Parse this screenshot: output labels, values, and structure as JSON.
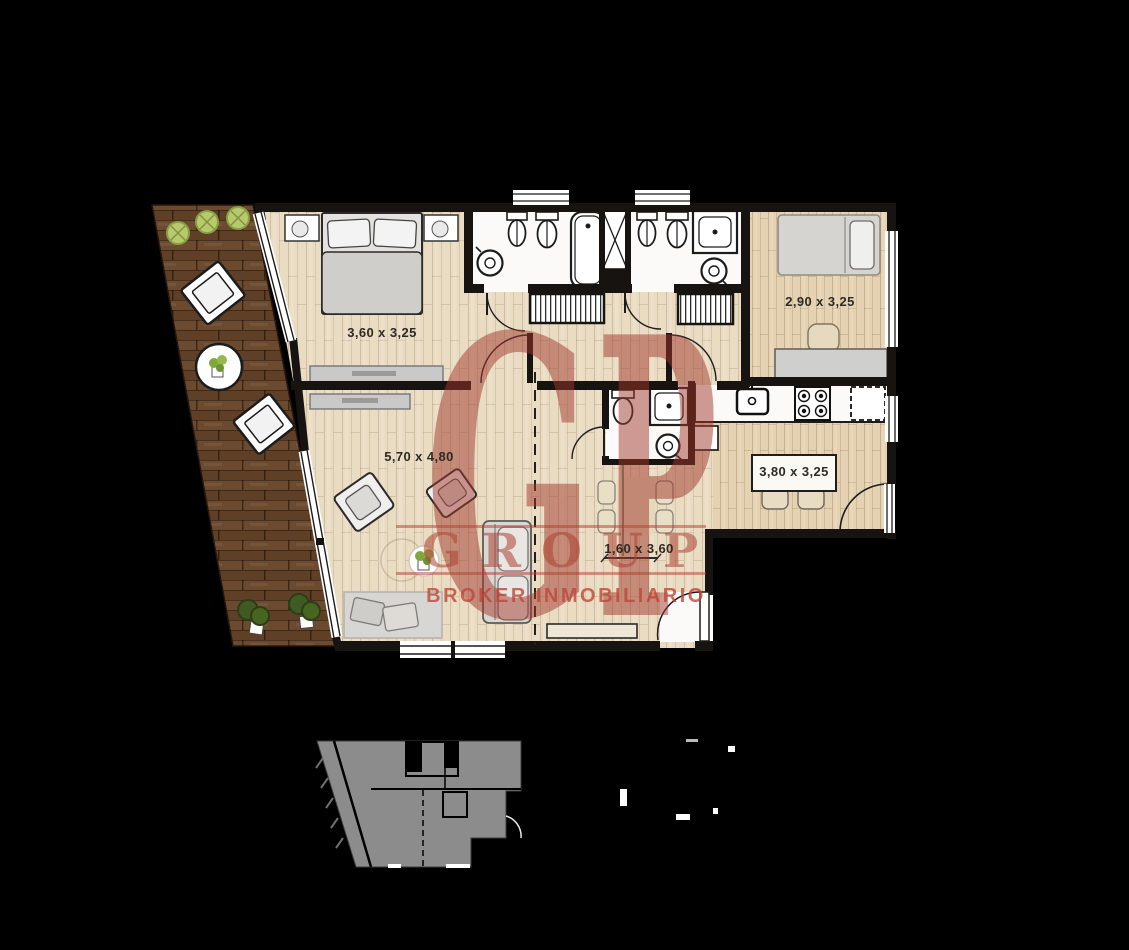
{
  "watermark": {
    "big_letters": [
      "G",
      "P"
    ],
    "line1": "GROUP",
    "line2": "BROKER INMOBILIARIO",
    "color": "#ad4032"
  },
  "rooms": [
    {
      "name": "bedroom-1",
      "dimension": "3,60 x 3,25"
    },
    {
      "name": "bedroom-2",
      "dimension": "2,90 x 3,25"
    },
    {
      "name": "living-room",
      "dimension": "5,70 x 4,80"
    },
    {
      "name": "kitchen-dining",
      "dimension": "3,80 x 3,25"
    },
    {
      "name": "hall",
      "dimension": "1,60 x 3,60"
    }
  ],
  "colors": {
    "background": "#000000",
    "interior_floor": "#e9dcc3",
    "warm_floor": "#e5d2b2",
    "terrace_deck": "#5f4027",
    "walls": "#161311",
    "key_plan_fill": "#8c8c8c",
    "watermark_red": "#ad4032"
  }
}
